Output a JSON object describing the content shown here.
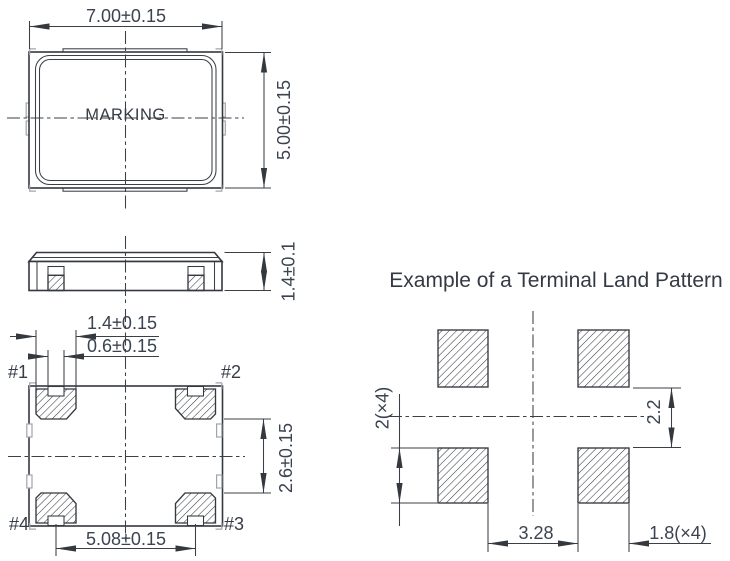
{
  "colors": {
    "background": "#ffffff",
    "line": "#34383f",
    "light_line": "#a0a5ab",
    "text": "#3b4350",
    "hatch": "#383c42"
  },
  "top_view": {
    "width_dim": "7.00±0.15",
    "height_dim": "5.00±0.15",
    "marking": "MARKING"
  },
  "side_view": {
    "height_dim": "1.4±0.1"
  },
  "bottom_view": {
    "pad_width_dim": "1.4±0.15",
    "notch_width_dim": "0.6±0.15",
    "pad_inner_gap_dim": "2.6±0.15",
    "pad_pitch_dim": "5.08±0.15",
    "pin_labels": {
      "pin1": "#1",
      "pin2": "#2",
      "pin3": "#3",
      "pin4": "#4"
    }
  },
  "land_pattern": {
    "title": "Example of a Terminal Land Pattern",
    "pad_height_dim": "2(×4)",
    "vertical_gap_dim": "2.2",
    "horizontal_gap_dim": "3.28",
    "pad_width_dim": "1.8(×4)"
  }
}
